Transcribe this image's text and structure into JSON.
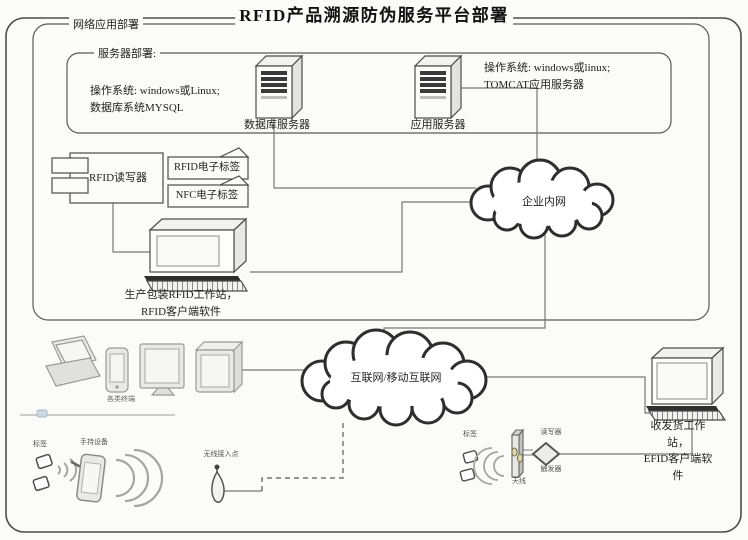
{
  "title": "RFID产品溯源防伪服务平台部署",
  "frames": {
    "network_label": "网络应用部署",
    "server_label": "服务器部署:"
  },
  "servers": {
    "database": {
      "name": "数据库服务器",
      "specs": "操作系统: windows或Linux;\n数据库系统MYSQL"
    },
    "application": {
      "name": "应用服务器",
      "specs": "操作系统: windows或linux;\nTOMCAT应用服务器"
    }
  },
  "devices": {
    "rfid_reader": "RFID读写器",
    "rfid_tag": "RFID电子标签",
    "nfc_tag": "NFC电子标签",
    "production_ws": "生产包装RFID工作站，\nRFID客户端软件",
    "shipping_ws": "收发货工作站，\nEFID客户端软件",
    "terminals": "各类终端",
    "tag_left": "标签",
    "handheld": "手持设备",
    "wap": "无线接入点",
    "tag_right": "标签",
    "antenna": "天线",
    "portal_reader": "读写器",
    "trigger": "触发器"
  },
  "networks": {
    "intranet": "企业内网",
    "internet": "互联网/移动互联网"
  },
  "colors": {
    "line": "#787878",
    "cloud_stroke": "#2e2e2e",
    "box_stroke": "#4c4c4c"
  }
}
